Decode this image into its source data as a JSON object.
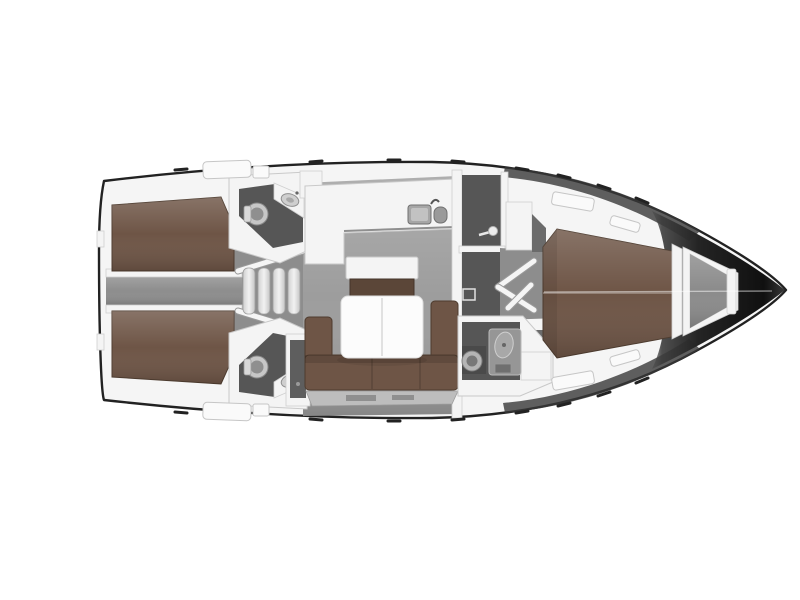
{
  "canvas": {
    "width": 800,
    "height": 600,
    "background": "#ffffff"
  },
  "colors": {
    "hull_edge": "#222222",
    "deck_white": "#f5f5f5",
    "furniture_white": "#f4f4f4",
    "floor_light": "#9d9d9d",
    "floor_mid": "#8d8d8d",
    "head_floor": "#565656",
    "upholstery_brown": "#6e5546",
    "upholstery_brown_dark": "#5b4638",
    "fixture_gray": "#a6a6a6",
    "locker_gray": "#bdbdbd",
    "anchor_gray": "#8b8b8b",
    "bow_dark": "#161616"
  },
  "icons": {
    "toilet": "toilet-icon",
    "sink": "sink-icon",
    "shower": "shower-head-icon",
    "galley_sink": "galley-sink-icon",
    "faucet": "faucet-icon",
    "door_swing": "door-swing-icon",
    "steps": "companionway-steps-icon"
  }
}
